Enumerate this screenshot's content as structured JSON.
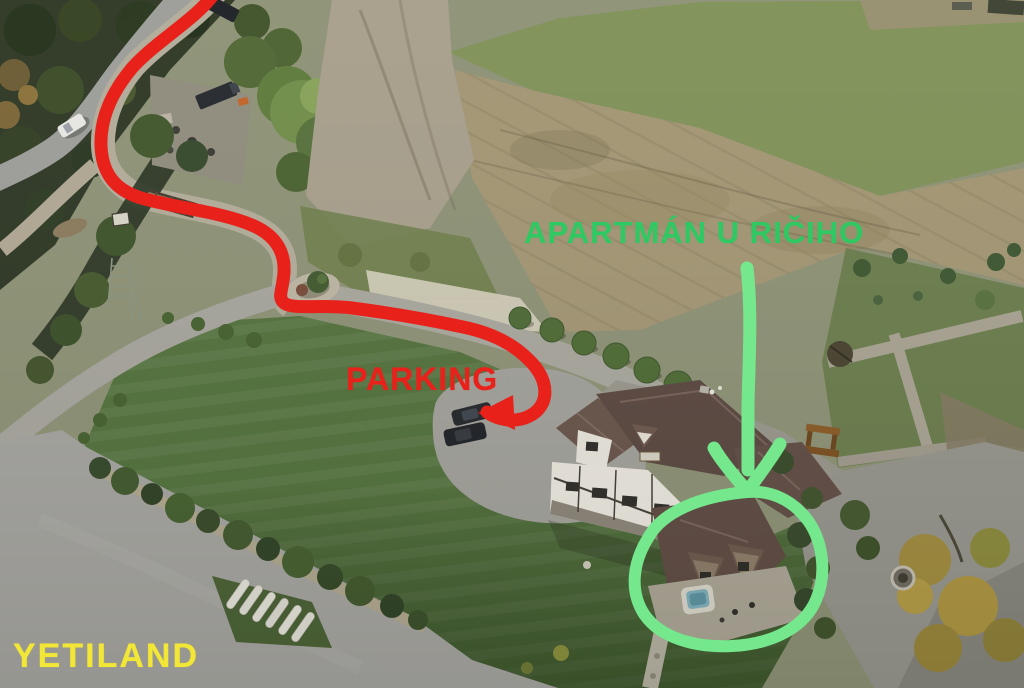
{
  "annotations": {
    "destination_label": "APARTMÁN U RIČIHO",
    "parking_label": "PARKING",
    "site_label": "YETILAND",
    "colors": {
      "route_red": "#e8211b",
      "highlight_green": "#75e78c",
      "destination_text_green": "#2fc863",
      "site_text_yellow": "#f2e636"
    }
  }
}
